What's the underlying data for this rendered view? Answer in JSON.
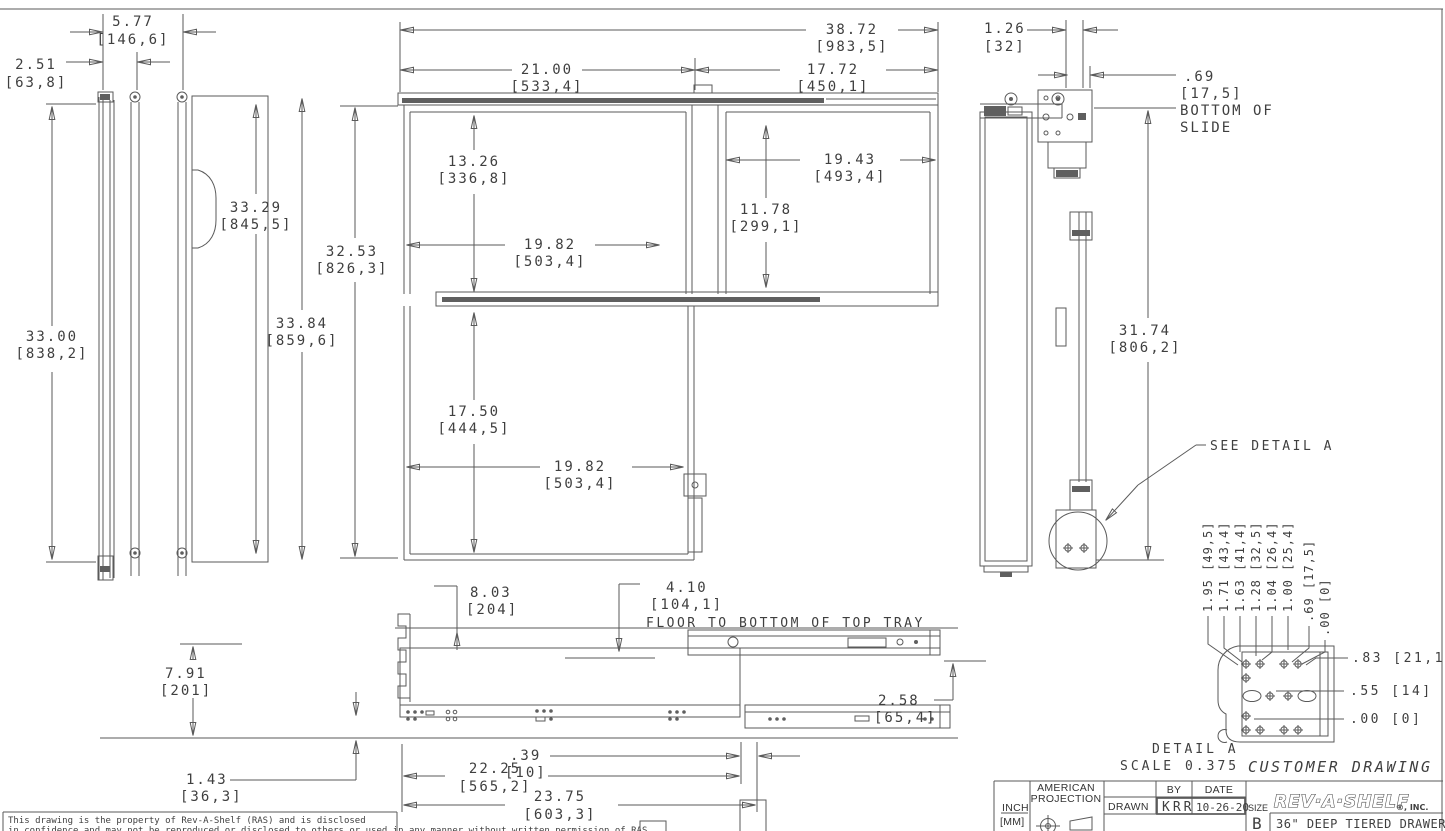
{
  "sheet": {
    "customer_drawing": "CUSTOMER DRAWING",
    "disclaimer_line1": "This drawing is the property of Rev-A-Shelf (RAS) and is disclosed",
    "disclaimer_line2": "in confidence and may not be reproduced or disclosed to others or used in any manner without written permission of RAS"
  },
  "title_block": {
    "units_inch": "INCH",
    "units_mm": "[MM]",
    "projection_line1": "AMERICAN",
    "projection_line2": "PROJECTION",
    "drawn_label": "DRAWN",
    "by_label": "BY",
    "date_label": "DATE",
    "drawn_by": "KRR",
    "date": "10-26-20",
    "size_label": "SIZE",
    "size_value": "B",
    "company": "REV·A·SHELF",
    "company_suffix": "®, INC.",
    "part_title": "36\" DEEP TIERED DRAWER"
  },
  "detail_a": {
    "callout": "SEE DETAIL A",
    "label": "DETAIL A",
    "scale": "SCALE 0.375",
    "rotated_dims": [
      "1.95 [49,5]",
      "1.71 [43,4]",
      "1.63 [41,4]",
      "1.28 [32,5]",
      "1.04 [26,4]",
      "1.00 [25,4]",
      ".69 [17,5]",
      ".00 [0]"
    ],
    "side_dims": [
      ".83 [21,1]",
      ".55 [14]",
      ".00 [0]"
    ]
  },
  "front_view": {
    "d5_77_in": "5.77",
    "d5_77_mm": "[146,6]",
    "d2_51_in": "2.51",
    "d2_51_mm": "[63,8]",
    "d33_29_in": "33.29",
    "d33_29_mm": "[845,5]",
    "d33_00_in": "33.00",
    "d33_00_mm": "[838,2]",
    "d33_84_in": "33.84",
    "d33_84_mm": "[859,6]",
    "d32_53_in": "32.53",
    "d32_53_mm": "[826,3]"
  },
  "plan_view": {
    "d38_72_in": "38.72",
    "d38_72_mm": "[983,5]",
    "d21_00_in": "21.00",
    "d21_00_mm": "[533,4]",
    "d17_72_in": "17.72",
    "d17_72_mm": "[450,1]",
    "d13_26_in": "13.26",
    "d13_26_mm": "[336,8]",
    "d19_43_in": "19.43",
    "d19_43_mm": "[493,4]",
    "d11_78_in": "11.78",
    "d11_78_mm": "[299,1]",
    "d19_82a_in": "19.82",
    "d19_82a_mm": "[503,4]",
    "d17_50_in": "17.50",
    "d17_50_mm": "[444,5]",
    "d19_82b_in": "19.82",
    "d19_82b_mm": "[503,4]"
  },
  "side_view": {
    "d1_26_in": "1.26",
    "d1_26_mm": "[32]",
    "d0_69_in": ".69",
    "d0_69_mm": "[17,5]",
    "bottom_of_slide_1": "BOTTOM OF",
    "bottom_of_slide_2": "SLIDE",
    "d31_74_in": "31.74",
    "d31_74_mm": "[806,2]"
  },
  "bottom_view": {
    "d8_03_in": "8.03",
    "d8_03_mm": "[204]",
    "d4_10_in": "4.10",
    "d4_10_mm": "[104,1]",
    "floor_note": "FLOOR TO BOTTOM OF TOP TRAY",
    "d7_91_in": "7.91",
    "d7_91_mm": "[201]",
    "d0_39_in": ".39",
    "d0_39_mm": "[10]",
    "d1_43_in": "1.43",
    "d1_43_mm": "[36,3]",
    "d22_25_in": "22.25",
    "d22_25_mm": "[565,2]",
    "d23_75_in": "23.75",
    "d23_75_mm": "[603,3]",
    "d2_58_in": "2.58",
    "d2_58_mm": "[65,4]"
  }
}
